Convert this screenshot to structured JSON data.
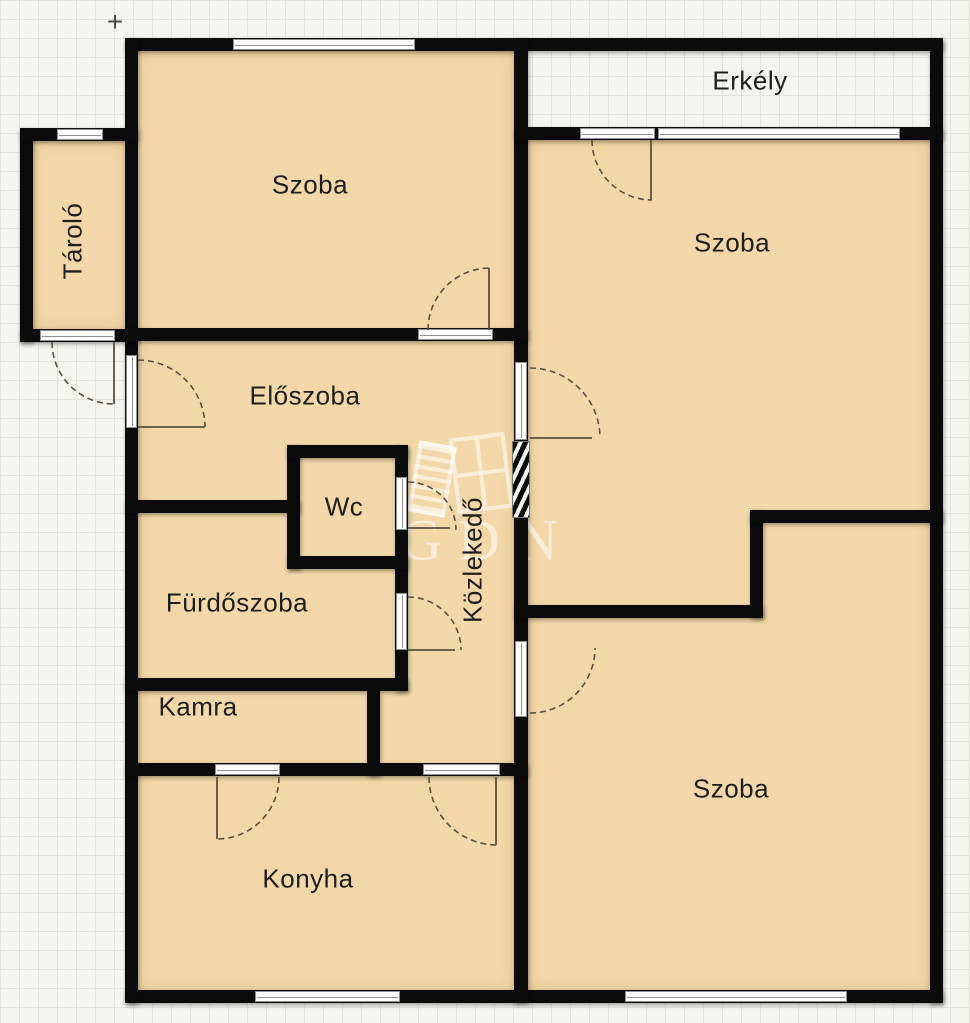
{
  "floorplan": {
    "marker": {
      "symbol": "+"
    },
    "watermark": {
      "text": "GDN"
    },
    "rooms": [
      {
        "id": "szoba-top-left",
        "label": "Szoba",
        "orientation": "horizontal"
      },
      {
        "id": "erkely",
        "label": "Erkély",
        "orientation": "horizontal"
      },
      {
        "id": "szoba-top-right",
        "label": "Szoba",
        "orientation": "horizontal"
      },
      {
        "id": "tarolo",
        "label": "Tároló",
        "orientation": "vertical"
      },
      {
        "id": "eloszoba",
        "label": "Előszoba",
        "orientation": "horizontal"
      },
      {
        "id": "wc",
        "label": "Wc",
        "orientation": "horizontal"
      },
      {
        "id": "kozlekedo",
        "label": "Közlekedő",
        "orientation": "vertical"
      },
      {
        "id": "furdoszoba",
        "label": "Fürdőszoba",
        "orientation": "horizontal"
      },
      {
        "id": "kamra",
        "label": "Kamra",
        "orientation": "horizontal"
      },
      {
        "id": "konyha",
        "label": "Konyha",
        "orientation": "horizontal"
      },
      {
        "id": "szoba-bottom-right",
        "label": "Szoba",
        "orientation": "horizontal"
      }
    ],
    "colors": {
      "wall": "#0b0b0b",
      "room_fill": "#f2d8a8",
      "background": "#f4f4f1",
      "grid_line": "#e3e3dd",
      "window_frame": "#8f8f8f",
      "door_arc": "#5a4f3f",
      "label_text": "#1e1e1e",
      "watermark": "rgba(255,255,255,0.55)"
    }
  }
}
